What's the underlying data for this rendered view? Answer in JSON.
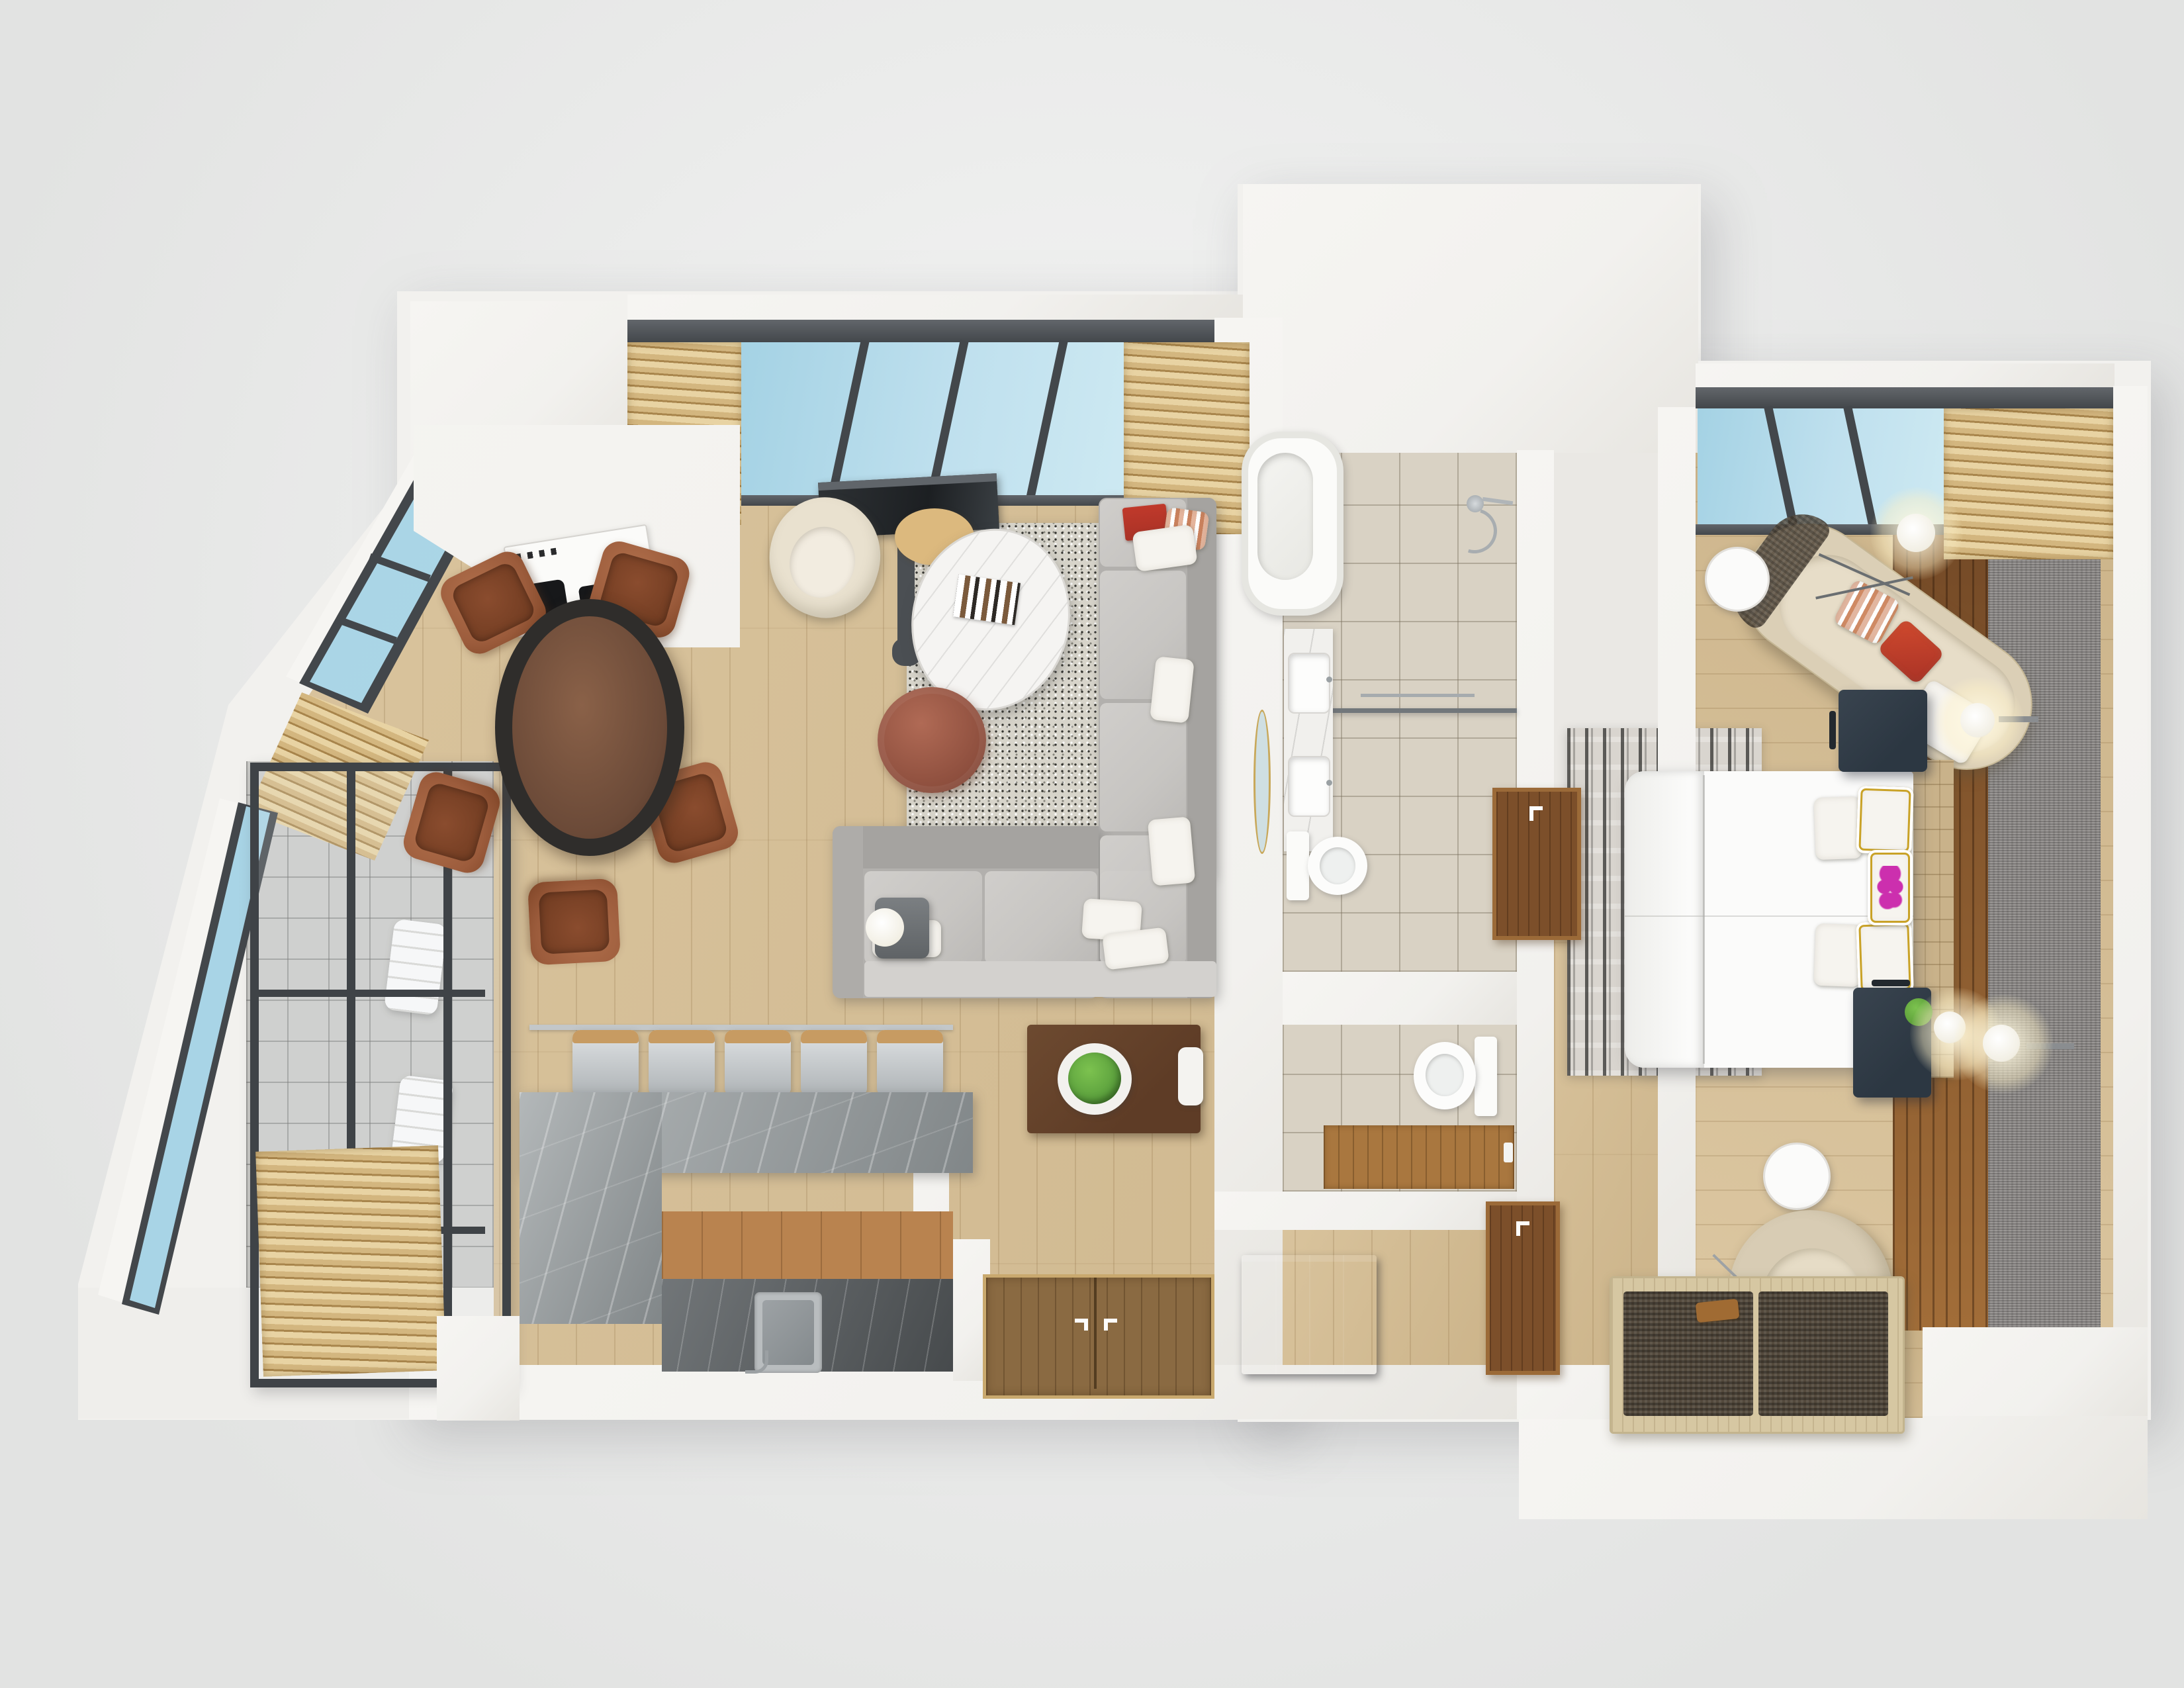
{
  "scene": {
    "type": "3d-floor-plan-render",
    "view": "top-down",
    "label": "apartment-floor-plan",
    "rooms_count": 6
  },
  "palette": {
    "bg": "#ebeceb",
    "wall": "#f2f1ee",
    "frame": "#43474b",
    "glass": "#bfe0ee",
    "glass2": "#a4d2e4",
    "wood": "#d7bf94",
    "tile": "#d9d2c4",
    "marble": "#9aa0a2",
    "sofa": "#c7c5c2",
    "sofad": "#b2b0ad",
    "leather": "#9c5c3c",
    "navy": "#2c3742",
    "carpet": "#8e8b89",
    "deck": "#8a5930",
    "door": "#7c4f2a",
    "gold": "#c9a227",
    "magenta": "#cc2fae",
    "green": "#5da23e",
    "red": "#a93226",
    "cream": "#e9e1cf",
    "walnut": "#5e3c26",
    "blind": "#d3b67f"
  },
  "rooms": {
    "living": {
      "label": "living-room",
      "furniture": [
        "l-shaped-sectional-sofa",
        "oval-marble-coffee-table",
        "round-knit-pouf",
        "speckled-area-rug",
        "tv-on-stand",
        "cream-armchair",
        "floor-lamp",
        "walnut-console-with-succulent"
      ]
    },
    "dining": {
      "label": "dining-area",
      "furniture": [
        "round-dark-wood-table",
        "leather-dining-chairs-x5"
      ]
    },
    "kitchen": {
      "label": "kitchen",
      "furniture": [
        "white-counter-with-cooktop",
        "l-shaped-marble-island",
        "bar-stools-x5",
        "undermount-sink"
      ]
    },
    "bathroom": {
      "label": "main-bathroom",
      "furniture": [
        "freestanding-tub",
        "walk-in-shower",
        "glass-partition",
        "double-sink-vanity",
        "round-mirror",
        "toilet"
      ]
    },
    "wc": {
      "label": "powder-room",
      "furniture": [
        "toilet",
        "wood-mat"
      ]
    },
    "hallway": {
      "label": "entry-hallway",
      "furniture": [
        "double-entry-door",
        "dark-shoe-cabinet",
        "wardrobe-doors-x2"
      ]
    },
    "bedroom": {
      "label": "bedroom",
      "furniture": [
        "double-bed-white-duvet",
        "tufted-headboard",
        "nightstands-x2",
        "curved-beige-sofa",
        "round-side-tables-x2",
        "swivel-armchair",
        "foot-bench-woven-cushions",
        "abstract-rug",
        "gray-carpet-runner",
        "wood-deck-strip",
        "wall-sconces-x2",
        "floor-lamp",
        "table-lamp"
      ]
    },
    "balcony": {
      "label": "glazed-balcony",
      "furniture": [
        "glass-partition-grid",
        "towel-stacks-x2",
        "wood-blinds"
      ]
    }
  },
  "counts": {
    "bar_stools": 5,
    "dining_chairs": 5,
    "vanity_sinks": 2,
    "toilets": 2,
    "wall_sconces": 2,
    "wardrobe_doors": 2,
    "towel_stacks": 2
  },
  "windows": {
    "left_wing_top": "blue-glass-band-with-wood-blinds-both-ends",
    "bedroom_top": "blue-glass-band-with-wood-blinds-right",
    "west_facade": "angled-glass-wall"
  },
  "accents": {
    "bed_pillow_graphic": "magenta-orchid",
    "sofa_book": "red",
    "plant": "green-succulent"
  }
}
